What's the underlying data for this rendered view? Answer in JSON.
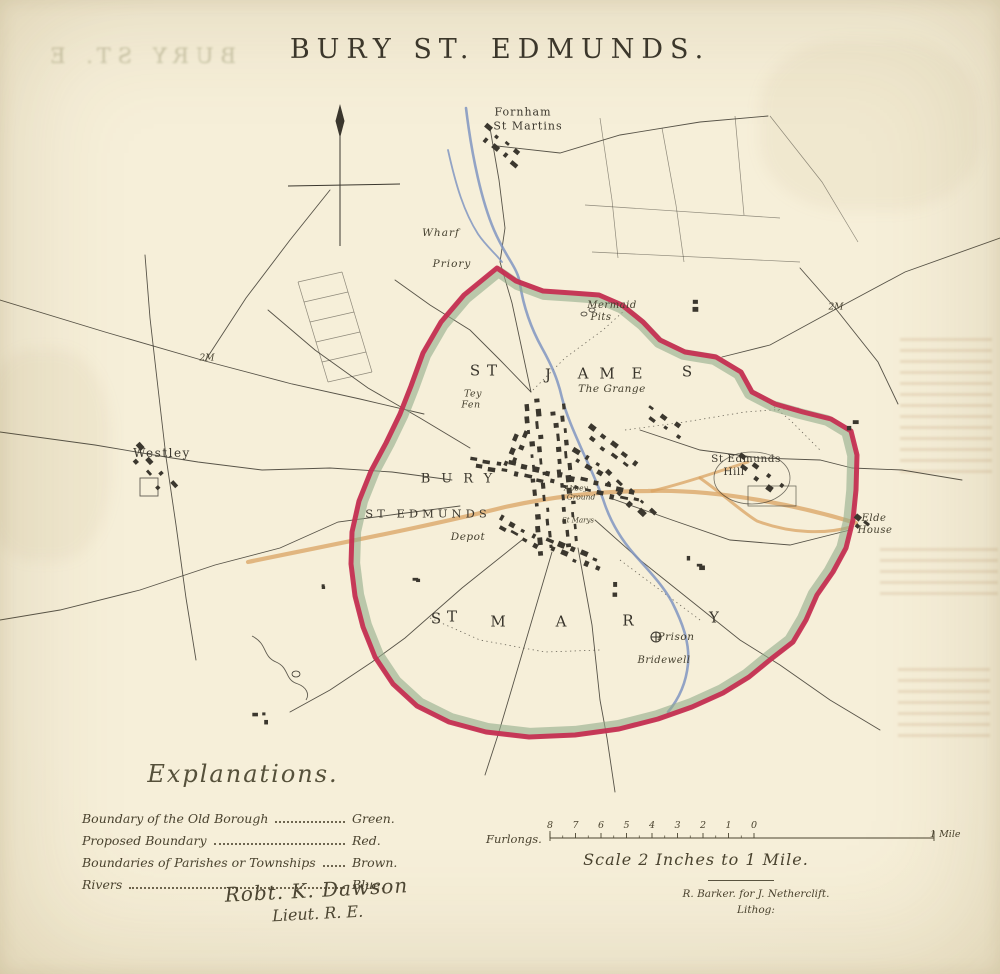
{
  "title": "BURY ST. EDMUNDS.",
  "ghost": {
    "text": "BURY ST. E"
  },
  "colors": {
    "paper": "#f5eed6",
    "ink": "#3b372e",
    "boundary_red": "#c62b50",
    "boundary_green": "#93ab8a",
    "parish_brown": "#d9a361",
    "river_blue": "#8095c1"
  },
  "map": {
    "district_names": [
      {
        "name": "ST JAMES",
        "letters": [
          {
            "ch": "S",
            "x": 475,
            "y": 371
          },
          {
            "ch": "T",
            "x": 492,
            "y": 371
          },
          {
            "ch": "J",
            "x": 548,
            "y": 375
          },
          {
            "ch": "A",
            "x": 583,
            "y": 374
          },
          {
            "ch": "M",
            "x": 607,
            "y": 374
          },
          {
            "ch": "E",
            "x": 637,
            "y": 374
          },
          {
            "ch": "S",
            "x": 687,
            "y": 372
          }
        ]
      },
      {
        "name": "ST MARY",
        "letters": [
          {
            "ch": "S",
            "x": 436,
            "y": 619
          },
          {
            "ch": "T",
            "x": 452,
            "y": 617
          },
          {
            "ch": "M",
            "x": 498,
            "y": 622
          },
          {
            "ch": "A",
            "x": 561,
            "y": 622
          },
          {
            "ch": "R",
            "x": 628,
            "y": 621
          },
          {
            "ch": "Y",
            "x": 714,
            "y": 618
          }
        ]
      }
    ],
    "labels": [
      {
        "id": "fornham-line1",
        "t": "Fornham",
        "x": 523,
        "y": 112,
        "fs": 11,
        "it": 0,
        "ls": 1
      },
      {
        "id": "fornham-line2",
        "t": "St Martins",
        "x": 528,
        "y": 126,
        "fs": 11,
        "it": 0,
        "ls": 1
      },
      {
        "id": "wharf",
        "t": "Wharf",
        "x": 441,
        "y": 233,
        "fs": 10.5,
        "it": 1,
        "ls": 1
      },
      {
        "id": "priory",
        "t": "Priory",
        "x": 452,
        "y": 264,
        "fs": 10.5,
        "it": 1,
        "ls": 1
      },
      {
        "id": "mermaid-pits-line1",
        "t": "Mermaid",
        "x": 612,
        "y": 306,
        "fs": 10,
        "it": 1,
        "ls": 0.5
      },
      {
        "id": "mermaid-pits-line2",
        "t": "Pits",
        "x": 601,
        "y": 318,
        "fs": 10,
        "it": 1,
        "ls": 0.5
      },
      {
        "id": "the-grange",
        "t": "The Grange",
        "x": 612,
        "y": 389,
        "fs": 10.5,
        "it": 1,
        "ls": 0.5
      },
      {
        "id": "tey-fen-line1",
        "t": "Tey",
        "x": 473,
        "y": 394,
        "fs": 9.5,
        "it": 1,
        "ls": 0.5
      },
      {
        "id": "tey-fen-line2",
        "t": "Fen",
        "x": 471,
        "y": 405,
        "fs": 9.5,
        "it": 1,
        "ls": 0.5
      },
      {
        "id": "westley",
        "t": "Westley",
        "x": 162,
        "y": 453,
        "fs": 12,
        "it": 0,
        "ls": 1.5
      },
      {
        "id": "two-mile-west",
        "t": "2M",
        "x": 207,
        "y": 359,
        "fs": 9,
        "it": 1,
        "ls": 0
      },
      {
        "id": "two-mile-east",
        "t": "2M",
        "x": 836,
        "y": 308,
        "fs": 9,
        "it": 1,
        "ls": 0
      },
      {
        "id": "bury",
        "t": "BURY",
        "x": 462,
        "y": 479,
        "fs": 13,
        "it": 0,
        "ls": 11
      },
      {
        "id": "st-edmunds",
        "t": "ST EDMUNDS",
        "x": 428,
        "y": 514,
        "fs": 11.5,
        "it": 0,
        "ls": 4
      },
      {
        "id": "abbey-ground-line1",
        "t": "Abbey",
        "x": 576,
        "y": 488,
        "fs": 7.5,
        "it": 1,
        "ls": 0
      },
      {
        "id": "abbey-ground-line2",
        "t": "Ground",
        "x": 581,
        "y": 497,
        "fs": 7.5,
        "it": 1,
        "ls": 0
      },
      {
        "id": "st-marys-church",
        "t": "St Marys",
        "x": 578,
        "y": 521,
        "fs": 7,
        "it": 1,
        "ls": 0
      },
      {
        "id": "depot",
        "t": "Depot",
        "x": 468,
        "y": 537,
        "fs": 10.5,
        "it": 1,
        "ls": 0.5
      },
      {
        "id": "st-edmunds-hill-line1",
        "t": "St Edmunds",
        "x": 746,
        "y": 459,
        "fs": 10.5,
        "it": 0,
        "ls": 0.5
      },
      {
        "id": "st-edmunds-hill-line2",
        "t": "Hill",
        "x": 734,
        "y": 472,
        "fs": 10.5,
        "it": 0,
        "ls": 0.5
      },
      {
        "id": "elde-house-line1",
        "t": "Elde",
        "x": 874,
        "y": 519,
        "fs": 10,
        "it": 1,
        "ls": 0.5
      },
      {
        "id": "elde-house-line2",
        "t": "House",
        "x": 875,
        "y": 531,
        "fs": 10,
        "it": 1,
        "ls": 0.5
      },
      {
        "id": "prison",
        "t": "Prison",
        "x": 676,
        "y": 637,
        "fs": 10.5,
        "it": 1,
        "ls": 0.5
      },
      {
        "id": "bridewell",
        "t": "Bridewell",
        "x": 664,
        "y": 661,
        "fs": 10,
        "it": 1,
        "ls": 0.5
      }
    ]
  },
  "legend": {
    "heading": "Explanations.",
    "rows": [
      {
        "label": "Boundary of the Old Borough",
        "value": "Green."
      },
      {
        "label": "Proposed Boundary",
        "value": "Red."
      },
      {
        "label": "Boundaries of Parishes or Townships",
        "value": "Brown."
      },
      {
        "label": "Rivers",
        "value": "Blue."
      }
    ]
  },
  "signature": {
    "line1": "Robt. K. Dawson",
    "line2": "Lieut. R. E."
  },
  "scale": {
    "label": "Furlongs.",
    "ticks": [
      "8",
      "7",
      "6",
      "5",
      "4",
      "3",
      "2",
      "1",
      "0"
    ],
    "mile_label": "1 Mile",
    "caption": "Scale 2 Inches to 1 Mile."
  },
  "imprint": {
    "line1": "R. Barker. for J. Netherclift.",
    "line2": "Lithog:"
  }
}
